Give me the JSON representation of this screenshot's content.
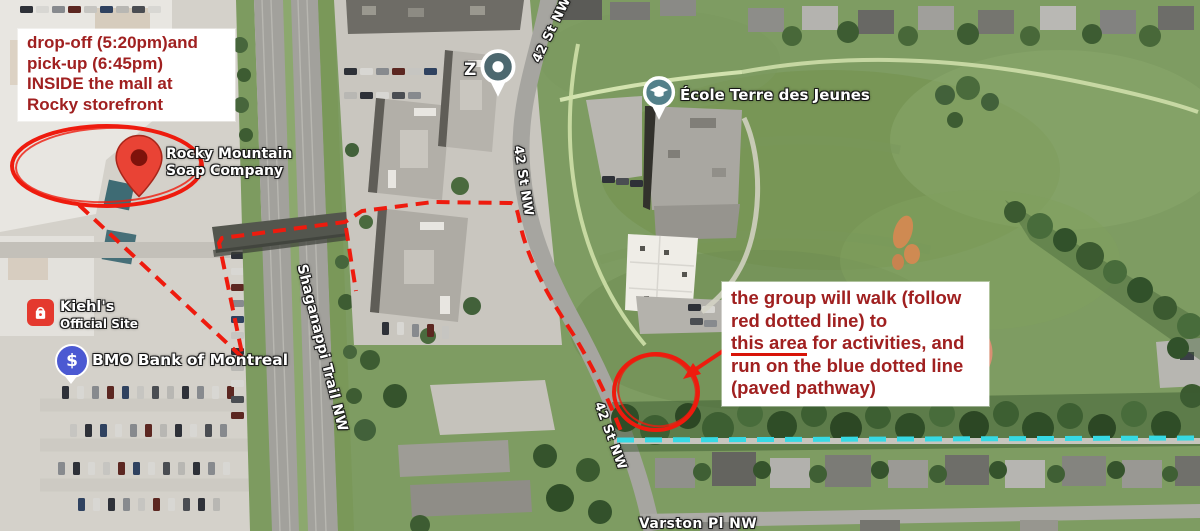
{
  "map": {
    "labels": {
      "rocky_line1": "Rocky Mountain",
      "rocky_line2": "Soap Company",
      "kiehls_name": "Kiehl's",
      "kiehls_sub": "Official Site",
      "bmo_name": "BMO Bank of Montreal",
      "bmo_symbol": "$",
      "ecole_name": "École Terre des Jeunes",
      "z_marker": "Z",
      "street_42": "42 St NW",
      "shaganappi": "Shaganappi Trail NW",
      "varston": "Varston Pl NW"
    }
  },
  "annotations": {
    "dropoff_note": {
      "line1": "drop-off (5:20pm)and",
      "line2": "pick-up (6:45pm)",
      "line3": "INSIDE the mall at",
      "line4": "Rocky storefront"
    },
    "walk_note": {
      "line1": "the group will walk (follow",
      "line2": "red dotted line) to",
      "line3_underlined": "this area",
      "line3_rest": " for activities, and",
      "line4": "run on the blue dotted line",
      "line5": "(paved pathway)"
    },
    "colors": {
      "route_red": "#ee1b0e",
      "note_text_red": "#a02020",
      "pathway_cyan": "#36d9e4"
    }
  }
}
